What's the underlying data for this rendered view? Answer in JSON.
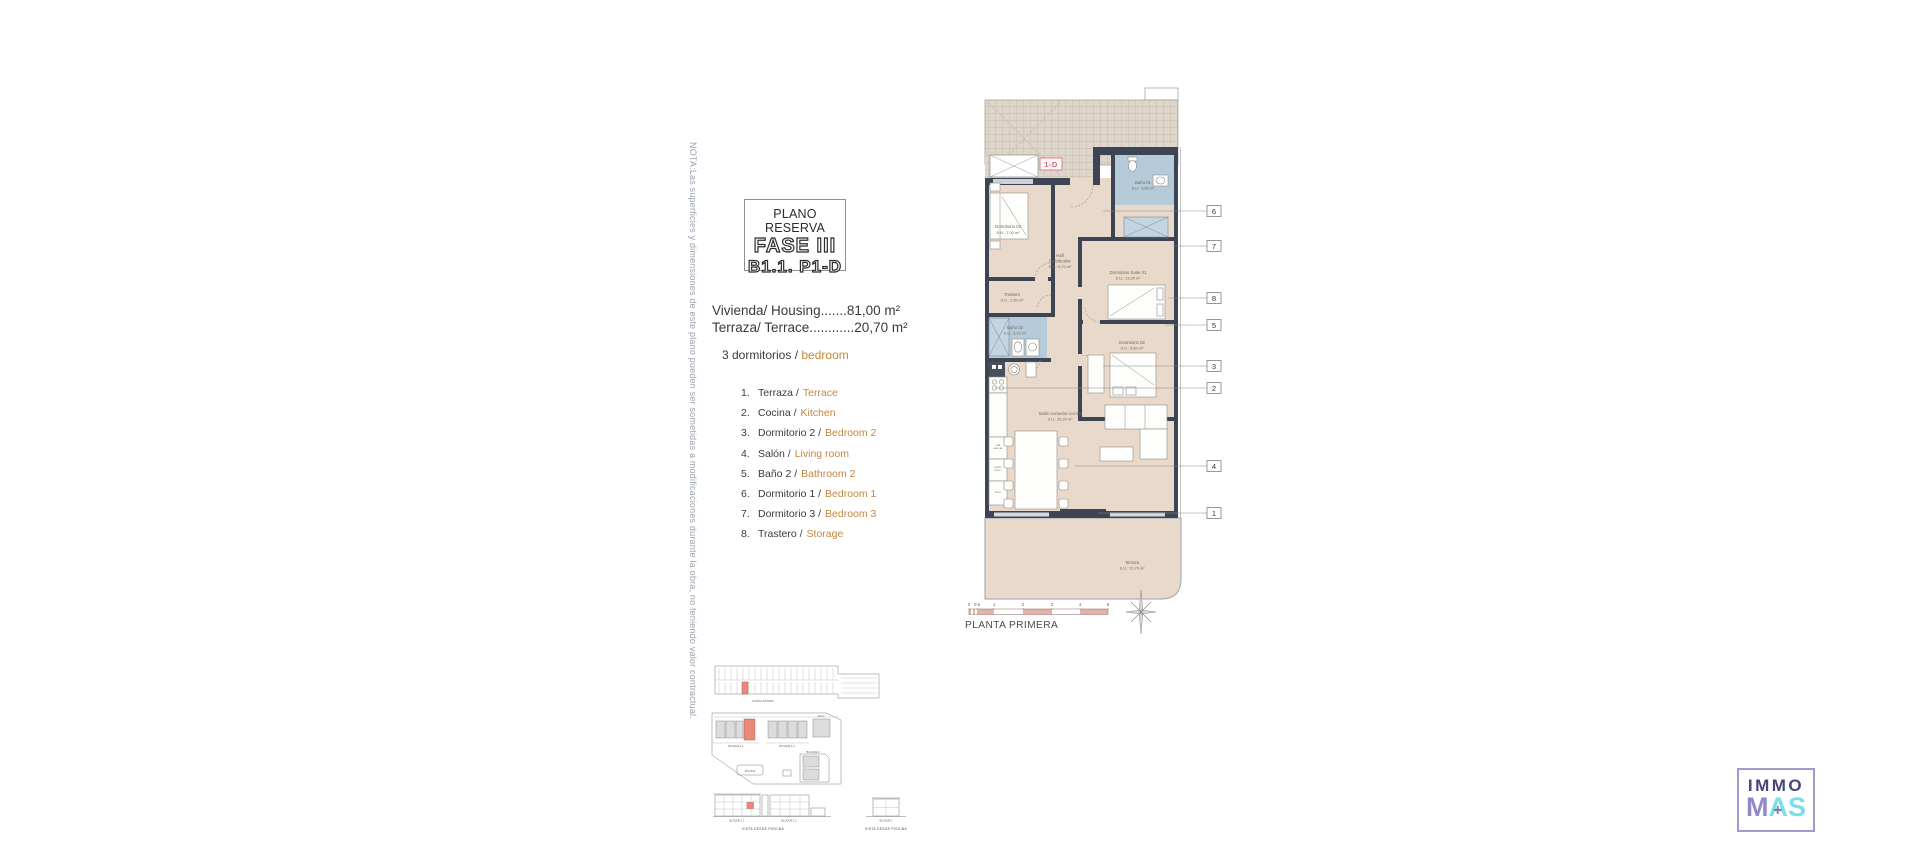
{
  "note_vertical": "NOTA:Las superficies y dimensiones de este plano pueden ser sometidas a modificaciones durante la obra, no teniendo valor contractual.",
  "title_block": {
    "kicker": "PLANO RESERVA",
    "phase": "FASE III",
    "unit": "B1.1. P1-D"
  },
  "areas": {
    "housing": "Vivienda/ Housing.......81,00 m²",
    "terrace": "Terraza/ Terrace............20,70 m²"
  },
  "bedrooms_line": {
    "es": "3 dormitorios /",
    "en": "bedroom"
  },
  "legend": [
    {
      "num": "1.",
      "es": "Terraza /",
      "en": "Terrace"
    },
    {
      "num": "2.",
      "es": "Cocina /",
      "en": "Kitchen"
    },
    {
      "num": "3.",
      "es": "Dormitorio 2 /",
      "en": "Bedroom 2"
    },
    {
      "num": "4.",
      "es": "Salón /",
      "en": "Living room"
    },
    {
      "num": "5.",
      "es": "Baño 2 /",
      "en": "Bathroom 2"
    },
    {
      "num": "6.",
      "es": "Dormitorio 1 /",
      "en": "Bedroom 1"
    },
    {
      "num": "7.",
      "es": "Dormitorio 3 /",
      "en": "Bedroom 3"
    },
    {
      "num": "8.",
      "es": "Trastero /",
      "en": "Storage"
    }
  ],
  "plan": {
    "unit_label": "1-D",
    "floor_label": "PLANTA PRIMERA",
    "rooms": [
      {
        "name": "Dormitorio 03",
        "area": "S.U.: 7,00 m²"
      },
      {
        "name": "Baño 01",
        "area": "S.U.: 3,68 m²"
      },
      {
        "name": "Hall",
        "name2": "Distribuidor",
        "area": "S.U.: 6,70 m²"
      },
      {
        "name": "Dormitorio Suite 01",
        "area": "S.U.: 13,20 m²"
      },
      {
        "name": "Trastero",
        "area": "S.U.: 2,50 m²"
      },
      {
        "name": "Baño 02",
        "area": "S.U.: 3,10 m²"
      },
      {
        "name": "Dormitorio 02",
        "area": "S.U.: 8,60 m²"
      },
      {
        "name": "Salón-comedor-cocina",
        "area": "S.U.: 26,20 m²"
      },
      {
        "name": "Terraza",
        "area": "S.U.: 20,70 m²"
      }
    ],
    "kitchen": [
      {
        "l1": "LAVA",
        "l2": "VAJILLAS"
      },
      {
        "l1": "HORNO",
        "l2": "MICRO"
      },
      {
        "l1": "FRIGO",
        "l2": ""
      }
    ],
    "callouts": [
      "6",
      "7",
      "8",
      "5",
      "3",
      "2",
      "4",
      "1"
    ],
    "scale_ticks": [
      "0",
      "0.5",
      "1",
      "2",
      "3",
      "4",
      "5"
    ]
  },
  "site": {
    "basement_label": "PLANTA SÓTANO",
    "block11": "BLOQUE 1.1",
    "block12": "BLOQUE 1.2",
    "block2": "BLOQUE 2",
    "villa": "VILLA",
    "piscina": "PISCINA",
    "elev_block11": "BLOQUE 1.1",
    "elev_block12": "BLOQUE 1.2",
    "elev_block2": "BLOQUE 2",
    "view": "VISTA DESDE PISCINA",
    "view2": "VISTA DESDE PISCINA"
  },
  "logo": {
    "top": "IMMO",
    "m": "M",
    "a": "A",
    "s": "S",
    "plus": "+"
  },
  "colors": {
    "accent_orange": "#c3873d",
    "plan_pink": "#d4697c",
    "wall": "#3d4554",
    "bath_blue": "#b5cbd9",
    "floor_beige": "#e9d9cb",
    "logo_purple": "#47457a",
    "logo_cyan": "#7cdfe8"
  }
}
